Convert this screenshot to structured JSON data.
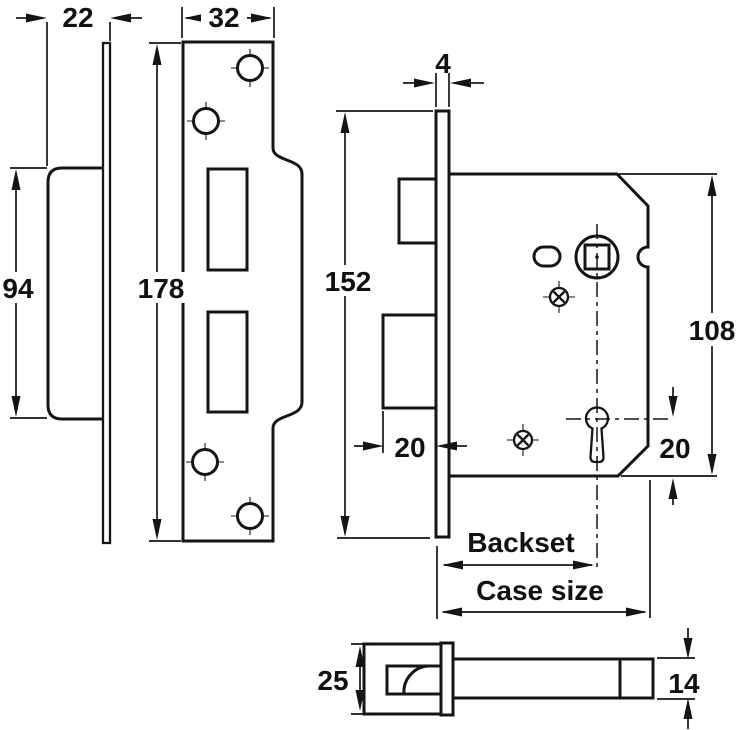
{
  "drawing": {
    "kind": "mortice-lock-dimension-diagram",
    "colors": {
      "line": "#151515",
      "background": "#ffffff"
    },
    "dims": {
      "plate_depth": "22",
      "strike_width": "32",
      "body_height": "94",
      "strike_height": "178",
      "faceplate_thickness": "4",
      "faceplate_height": "152",
      "bolt_throw": "20",
      "keyhole_offset": "20",
      "case_height": "108",
      "backset_label": "Backset",
      "case_size_label": "Case size",
      "latch_head_height": "25",
      "latch_body_height": "14"
    }
  }
}
